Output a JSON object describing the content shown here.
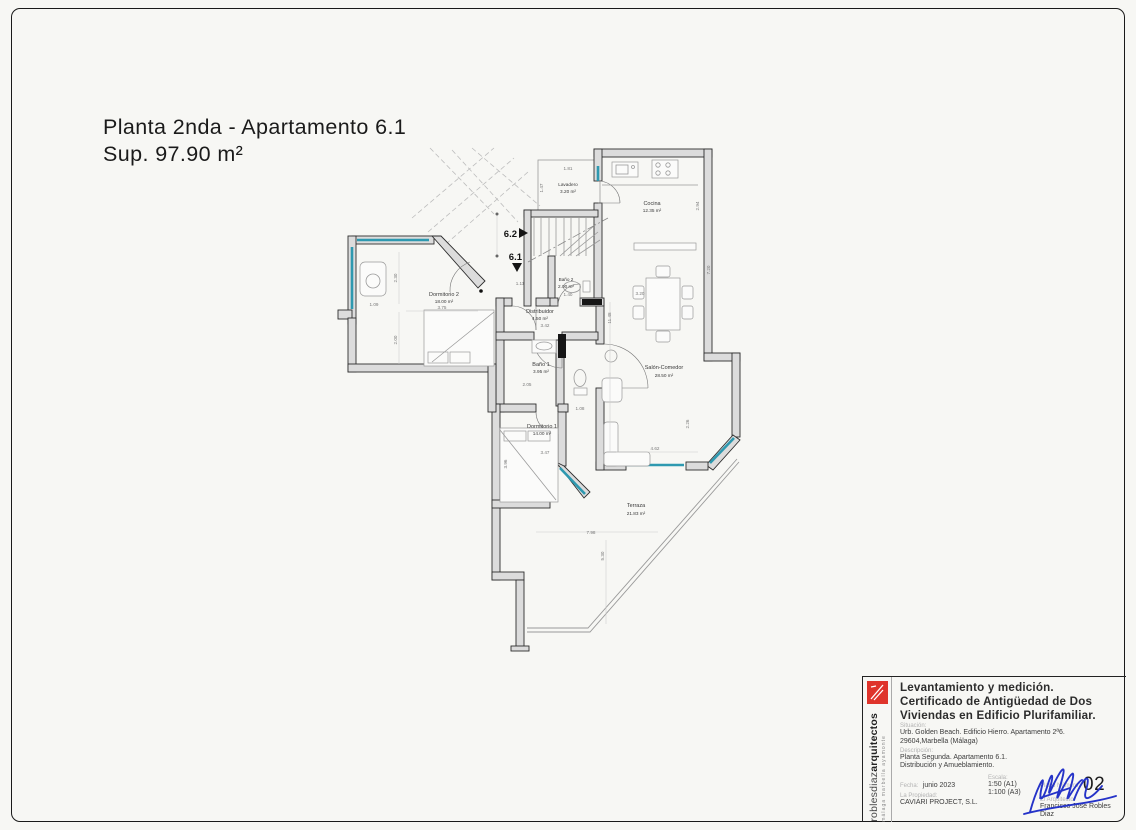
{
  "page": {
    "title_line1": "Planta 2nda - Apartamento  6.1",
    "title_line2": "Sup. 97.90 m²"
  },
  "plan": {
    "rooms": [
      {
        "name": "Lavadero",
        "area": "3.20 m²"
      },
      {
        "name": "Cocina",
        "area": "12.35 m²"
      },
      {
        "name": "Dormitorio 2",
        "area": "18.00 m²"
      },
      {
        "name": "Baño 2",
        "area": "2.00 m²"
      },
      {
        "name": "Distribuidor",
        "area": "4.50 m²"
      },
      {
        "name": "Baño 1",
        "area": "3.95 m²"
      },
      {
        "name": "Salón-Comedor",
        "area": "28.50 m²"
      },
      {
        "name": "Dormitorio 1",
        "area": "14.00 m²"
      },
      {
        "name": "Terraza",
        "area": "21.83 m²"
      }
    ],
    "markers": {
      "adjacent_unit": "6.2",
      "unit": "6.1"
    },
    "dimensions": [
      {
        "x": 442,
        "y": 309,
        "r": 0,
        "t": "3.75"
      },
      {
        "x": 397,
        "y": 278,
        "r": -90,
        "t": "2.30"
      },
      {
        "x": 397,
        "y": 340,
        "r": -90,
        "t": "2.00"
      },
      {
        "x": 374,
        "y": 306,
        "r": 0,
        "t": "1.09"
      },
      {
        "x": 520,
        "y": 285,
        "r": 0,
        "t": "1.11"
      },
      {
        "x": 545,
        "y": 327,
        "r": 0,
        "t": "3.42"
      },
      {
        "x": 568,
        "y": 170,
        "r": 0,
        "t": "1.81"
      },
      {
        "x": 543,
        "y": 188,
        "r": -90,
        "t": "1.47"
      },
      {
        "x": 699,
        "y": 206,
        "r": -90,
        "t": "2.94"
      },
      {
        "x": 710,
        "y": 270,
        "r": -90,
        "t": "7.20"
      },
      {
        "x": 611,
        "y": 318,
        "r": -90,
        "t": "11.48"
      },
      {
        "x": 640,
        "y": 295,
        "r": 0,
        "t": "3.20"
      },
      {
        "x": 655,
        "y": 450,
        "r": 0,
        "t": "4.62"
      },
      {
        "x": 689,
        "y": 424,
        "r": -90,
        "t": "2.26"
      },
      {
        "x": 545,
        "y": 454,
        "r": 0,
        "t": "3.47"
      },
      {
        "x": 507,
        "y": 464,
        "r": -90,
        "t": "3.96"
      },
      {
        "x": 580,
        "y": 410,
        "r": 0,
        "t": "1.08"
      },
      {
        "x": 591,
        "y": 534,
        "r": 0,
        "t": "7.98"
      },
      {
        "x": 604,
        "y": 556,
        "r": -90,
        "t": "5.30"
      },
      {
        "x": 527,
        "y": 386,
        "r": 0,
        "t": "2.05"
      },
      {
        "x": 568,
        "y": 296,
        "r": 0,
        "t": "1.40"
      }
    ],
    "colors": {
      "wall_fill": "#dcdcdc",
      "wall_stroke": "#2e2e2e",
      "window": "#2e99b0",
      "signature": "#2533c8",
      "logo": "#df342b"
    }
  },
  "titleblock": {
    "firm": {
      "name_light": "roblesdiaz",
      "name_bold": "arquitectos",
      "cities": "málaga  marbella  ayamonte"
    },
    "heading": [
      "Levantamiento y medición.",
      "Certificado de Antigüedad de Dos",
      "Viviendas en Edificio Plurifamiliar."
    ],
    "situacion": {
      "label": "Situación:",
      "lines": [
        "Urb. Golden Beach.  Edificio Hierro. Apartamento  2ª6.",
        "29604,Marbella (Málaga)"
      ]
    },
    "descripcion": {
      "label": "Descripción:",
      "lines": [
        "Planta Segunda. Apartamento  6.1.",
        "Distribución y Amueblamiento."
      ]
    },
    "fecha": {
      "label": "Fecha:",
      "value": "junio 2023"
    },
    "escala": {
      "label": "Escala:",
      "values": [
        "1:50 (A1)",
        "1:100 (A3)"
      ]
    },
    "propiedad": {
      "label": "La Propiedad:",
      "value": "CAVIARI  PROJECT, S.L."
    },
    "plano": {
      "label": "Plano Número:",
      "value": "02"
    },
    "arquitecto": {
      "label": "El Arquitecto:",
      "value": "Francisco Jose Robles Diaz"
    }
  }
}
